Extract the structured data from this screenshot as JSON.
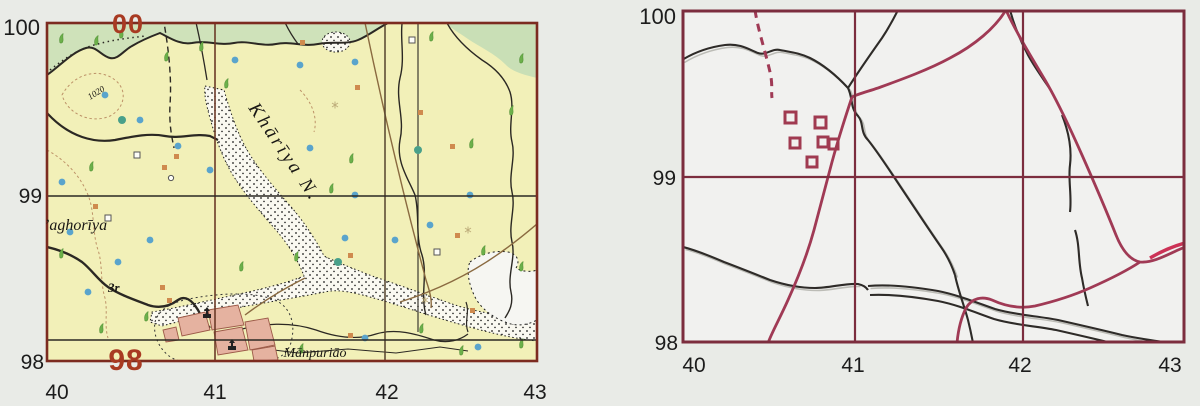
{
  "page": {
    "background": "#e9ebe7"
  },
  "left_map": {
    "northings": [
      "100",
      "99",
      "98"
    ],
    "eastings": [
      "40",
      "41",
      "42",
      "43"
    ],
    "grid_digits": {
      "top": "00",
      "bottom": "98"
    },
    "place_names": {
      "river": "Khārīya N.",
      "village_west": "’aghorīya",
      "village_south": "Mānpuriāo",
      "stream_note": "3r",
      "contour_label": "1020"
    },
    "colors": {
      "sheet": "#f2f0b8",
      "vegetation": "#cfe2ba",
      "channel": "#faf9f1",
      "grid_border": "#7c2b20",
      "grid_digit": "#a83a22",
      "stream": "#2b2823",
      "track": "#8a6a40",
      "village_fill": "#e5b2a0",
      "village_stroke": "#9c5a48",
      "well": "#5aa4cc",
      "scrub": "#6cb04a",
      "hut": "#cf8a4e",
      "contour": "#bd9268"
    },
    "icons": [
      {
        "name": "well-icon",
        "shape": "dot",
        "color": "#5aa4cc"
      },
      {
        "name": "scrub-icon",
        "shape": "leaf",
        "color": "#6cb04a"
      },
      {
        "name": "hut-icon",
        "shape": "square",
        "color": "#cf8a4e"
      },
      {
        "name": "temple-icon",
        "shape": "shrine",
        "color": "#222222"
      }
    ]
  },
  "right_map": {
    "northings": [
      "100",
      "99",
      "98"
    ],
    "eastings": [
      "40",
      "41",
      "42",
      "43"
    ],
    "colors": {
      "sheet": "#f1f1ef",
      "grid": "#7c2d3e",
      "road": "#a03a55",
      "road_highlight": "#cc3256",
      "stream": "#2e2b28",
      "stream_shadow": "#bcbcb6",
      "building": "#a03a50"
    },
    "icons": [
      {
        "name": "building-icon",
        "shape": "hollow-square",
        "color": "#a03a50"
      }
    ]
  }
}
